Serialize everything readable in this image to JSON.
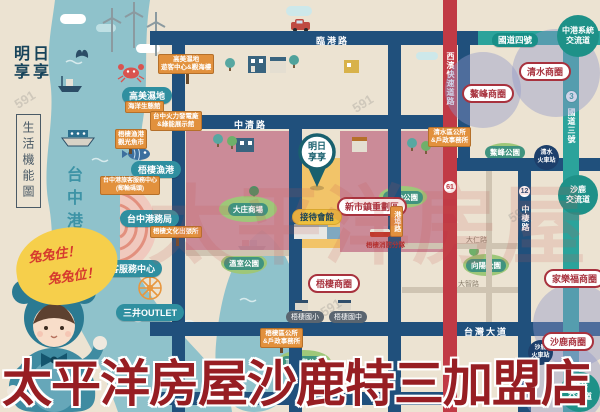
{
  "branding": {
    "logo_line1": "明日",
    "logo_line2": "享享",
    "sidebar_box": "生活機能圖",
    "area_label": "台中港區",
    "bubble_line1": "兔兔住！",
    "bubble_line2": "兔兔位！"
  },
  "pin": {
    "line1": "明日",
    "line2": "享享",
    "reception": "接待會館"
  },
  "roads": {
    "lingang": "臨港路",
    "zhongqing": "中清路",
    "taiwan_blvd": "台灣大道",
    "zhongqi": "中棲路",
    "hw4": "國道四號",
    "hw3": "國道三號",
    "expressway": "西濱快速道路",
    "gangbu": "港埠路",
    "badge61": "61",
    "badge3": "3",
    "badge12": "12",
    "minor1": "大仁路",
    "minor2": "大智路"
  },
  "interchanges": [
    [
      "中港系統",
      "交流道"
    ],
    [
      "沙鹿",
      "交流道"
    ],
    [
      "龍井",
      "交流道"
    ]
  ],
  "stations": [
    [
      "清水",
      "火車站"
    ],
    [
      "沙鹿",
      "火車站"
    ]
  ],
  "districts": [
    "清水商圈",
    "鰲峰商圈",
    "新市鎮重劃區",
    "梧棲商圈",
    "家樂福商圈",
    "沙鹿商圈"
  ],
  "places": [
    "高美濕地",
    "梧棲漁港",
    "台中港務局",
    "遊客服務中心",
    "三井OUTLET"
  ],
  "parks": [
    "大庄商場",
    "運動公園",
    "溫室公園",
    "頂魚寮公園",
    "向陽公園",
    "鰲峰公園"
  ],
  "signs": [
    {
      "lines": [
        "高美濕地",
        "遊客中心&觀海樓"
      ]
    },
    {
      "lines": [
        "海洋生態館"
      ]
    },
    {
      "lines": [
        "台中火力發電廠",
        "&綠能展示館"
      ]
    },
    {
      "lines": [
        "梧棲漁港",
        "觀光魚市"
      ]
    },
    {
      "lines": [
        "台中港旅客服務中心",
        "(郵輪碼頭)"
      ]
    },
    {
      "lines": [
        "梧棲文化出張所"
      ]
    },
    {
      "lines": [
        "清水區公所",
        "&戶政事務所"
      ]
    },
    {
      "lines": [
        "梧棲區公所",
        "&戶政事務所"
      ]
    }
  ],
  "schools": [
    "梧棲國小",
    "梧棲國中"
  ],
  "fire_station": "梧棲消防分隊",
  "watermarks": {
    "big": "太平洋房屋",
    "small": "591"
  },
  "footer": {
    "title": "太平洋房屋沙鹿特三加盟店"
  }
}
